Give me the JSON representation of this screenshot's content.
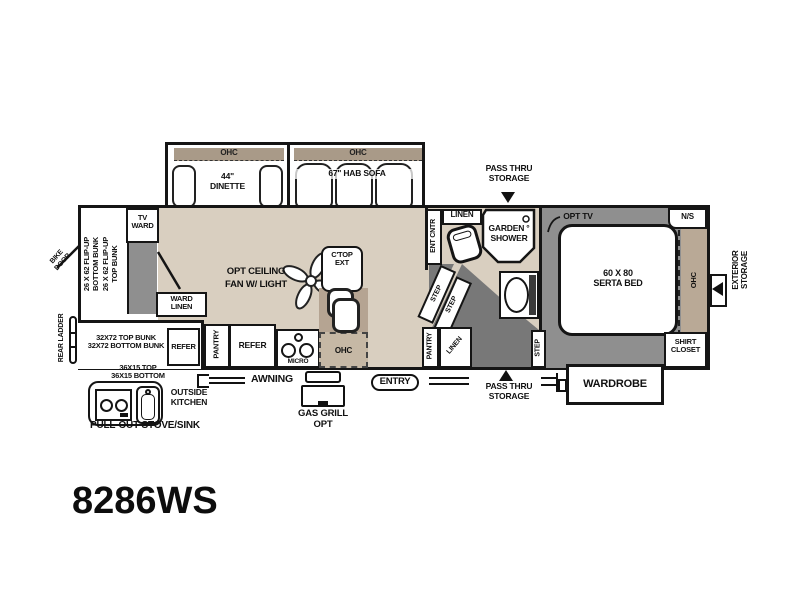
{
  "title": "8286WS",
  "colors": {
    "wall": "#151515",
    "floor": "#d9cfc0",
    "counter": "#b5a492",
    "ohc_dashed": "#c6b8a5",
    "ohc_strip": "#a99a88",
    "room_gray": "#8f8f8f",
    "stairs_gray": "#787878",
    "fixture_white": "#ffffff"
  },
  "labels": {
    "ohc": "OHC",
    "dinette": "44\"\nDINETTE",
    "sofa": "67\" HAB SOFA",
    "pass_thru": "PASS THRU\nSTORAGE",
    "linen": "LINEN",
    "ent_cntr": "ENT CNTR",
    "garden_shower": "GARDEN °\nSHOWER",
    "opt_tv": "OPT TV",
    "night_stand": "N/S",
    "bed": "60 X 80\nSERTA BED",
    "exterior_storage": "EXTERIOR\nSTORAGE",
    "shirt_closet": "SHIRT\nCLOSET",
    "wardrobe": "WARDROBE",
    "step": "STEP",
    "pantry": "PANTRY",
    "bike_door": "BIKE\nDOOR",
    "tv_ward": "TV\nWARD",
    "flip_bunks": "26 X 62 FLIP-UP\nBOTTOM BUNK\n26 X 62 FLIP-UP\nTOP BUNK",
    "ward_linen": "WARD\nLINEN",
    "ceiling_fan": "OPT CEILING\nFAN W/ LIGHT",
    "ctop_ext": "C'TOP\nEXT",
    "rear_ladder": "REAR LADDER",
    "bunks_32": "32X72 TOP BUNK\n32X72 BOTTOM BUNK",
    "refer": "REFER",
    "micro": "MICRO",
    "outside_size": "36X15 TOP\n36X15 BOTTOM",
    "outside_kitchen": "OUTSIDE\nKITCHEN",
    "pull_out": "PULL-OUT STOVE/SINK",
    "awning": "AWNING",
    "gas_grill": "GAS GRILL OPT",
    "entry": "ENTRY"
  }
}
